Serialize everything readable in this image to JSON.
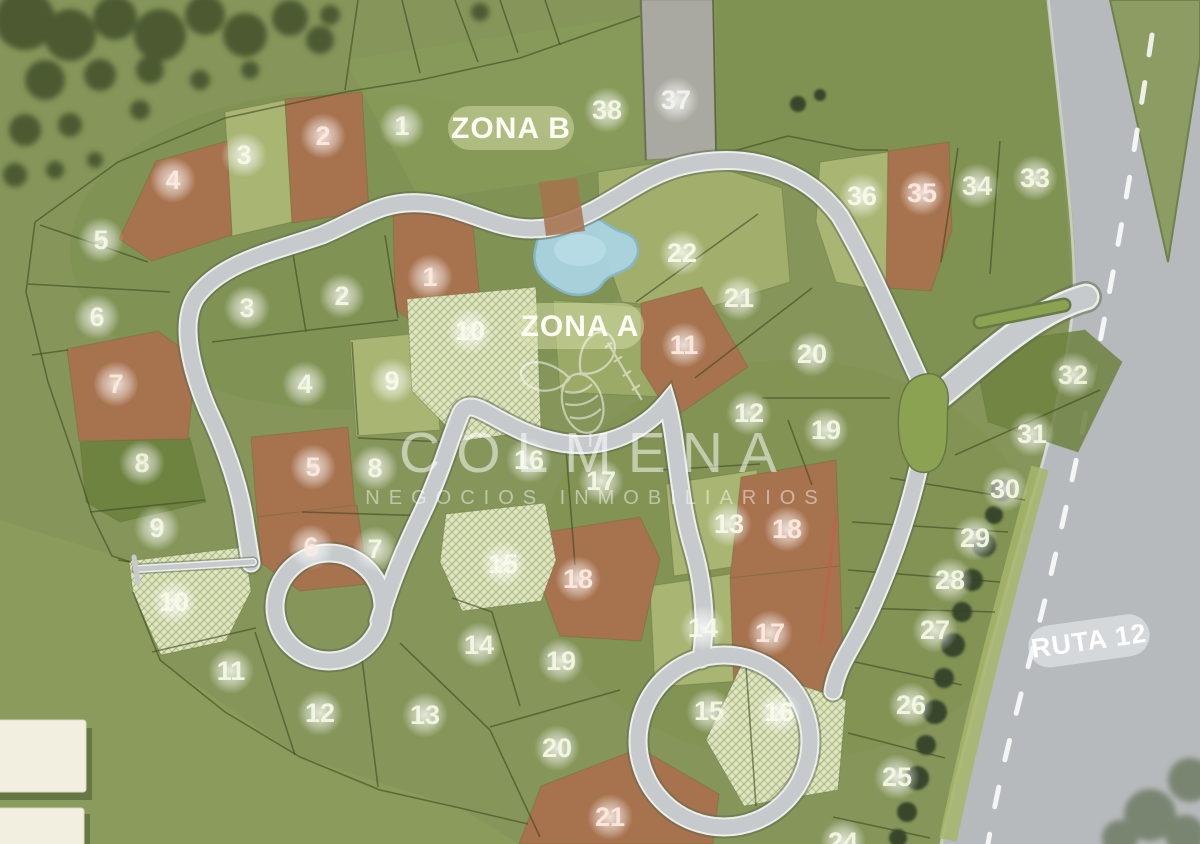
{
  "map": {
    "zone_labels": [
      {
        "text": "ZONA B"
      },
      {
        "text": "ZONA A"
      }
    ],
    "route_label": {
      "text": "RUTA 12"
    },
    "watermark": {
      "brand": "COLMENA",
      "tagline": "NEGOCIOS INMOBILIARIOS"
    },
    "palette": {
      "grass_base": "#86965a",
      "lot_green": "#7d9148",
      "lot_light_olive": "#a9b573",
      "lot_dark_green": "#6f8340",
      "lot_brown": "#a7724e",
      "lot_hatched": "#dfe5c3",
      "lot_gray": "#a9a9a1",
      "road_gray": "#c6cacc",
      "highway_gray": "#b7babc",
      "water_blue": "#aad4e2",
      "tree_green": "#43502c",
      "marker_text": "#ffffff"
    },
    "lots": [
      {
        "ring": "outer",
        "n": 1,
        "x": 402,
        "y": 126,
        "s": "green"
      },
      {
        "ring": "outer",
        "n": 2,
        "x": 323,
        "y": 136,
        "s": "brown"
      },
      {
        "ring": "outer",
        "n": 3,
        "x": 244,
        "y": 155,
        "s": "light"
      },
      {
        "ring": "outer",
        "n": 4,
        "x": 173,
        "y": 180,
        "s": "brown"
      },
      {
        "ring": "outer",
        "n": 5,
        "x": 101,
        "y": 240,
        "s": "green"
      },
      {
        "ring": "outer",
        "n": 6,
        "x": 97,
        "y": 317,
        "s": "green"
      },
      {
        "ring": "outer",
        "n": 7,
        "x": 116,
        "y": 384,
        "s": "brown"
      },
      {
        "ring": "outer",
        "n": 8,
        "x": 142,
        "y": 463,
        "s": "dark"
      },
      {
        "ring": "outer",
        "n": 9,
        "x": 157,
        "y": 528,
        "s": "green"
      },
      {
        "ring": "outer",
        "n": 10,
        "x": 174,
        "y": 602,
        "s": "hatched"
      },
      {
        "ring": "outer",
        "n": 11,
        "x": 231,
        "y": 671,
        "s": "green"
      },
      {
        "ring": "outer",
        "n": 12,
        "x": 320,
        "y": 713,
        "s": "green"
      },
      {
        "ring": "outer",
        "n": 13,
        "x": 425,
        "y": 715,
        "s": "green"
      },
      {
        "ring": "outer",
        "n": 14,
        "x": 479,
        "y": 645,
        "s": "green"
      },
      {
        "ring": "outer",
        "n": 15,
        "x": 503,
        "y": 564,
        "s": "hatched"
      },
      {
        "ring": "outer",
        "n": 16,
        "x": 529,
        "y": 460,
        "s": "green"
      },
      {
        "ring": "outer",
        "n": 17,
        "x": 601,
        "y": 481,
        "s": "green"
      },
      {
        "ring": "outer",
        "n": 18,
        "x": 578,
        "y": 579,
        "s": "brown"
      },
      {
        "ring": "outer",
        "n": 19,
        "x": 561,
        "y": 661,
        "s": "green"
      },
      {
        "ring": "outer",
        "n": 20,
        "x": 557,
        "y": 748,
        "s": "green"
      },
      {
        "ring": "outer",
        "n": 21,
        "x": 610,
        "y": 817,
        "s": "brown"
      },
      {
        "ring": "outer",
        "n": 24,
        "x": 843,
        "y": 842,
        "s": "green"
      },
      {
        "ring": "outer",
        "n": 25,
        "x": 897,
        "y": 777,
        "s": "green"
      },
      {
        "ring": "outer",
        "n": 26,
        "x": 911,
        "y": 705,
        "s": "green"
      },
      {
        "ring": "outer",
        "n": 27,
        "x": 935,
        "y": 630,
        "s": "green"
      },
      {
        "ring": "outer",
        "n": 28,
        "x": 950,
        "y": 580,
        "s": "green"
      },
      {
        "ring": "outer",
        "n": 29,
        "x": 975,
        "y": 538,
        "s": "green"
      },
      {
        "ring": "outer",
        "n": 30,
        "x": 1005,
        "y": 489,
        "s": "green"
      },
      {
        "ring": "outer",
        "n": 31,
        "x": 1032,
        "y": 434,
        "s": "green"
      },
      {
        "ring": "outer",
        "n": 32,
        "x": 1073,
        "y": 375,
        "s": "dark"
      },
      {
        "ring": "outer",
        "n": 33,
        "x": 1035,
        "y": 178,
        "s": "green"
      },
      {
        "ring": "outer",
        "n": 34,
        "x": 977,
        "y": 186,
        "s": "green"
      },
      {
        "ring": "outer",
        "n": 35,
        "x": 922,
        "y": 193,
        "s": "brown"
      },
      {
        "ring": "outer",
        "n": 36,
        "x": 862,
        "y": 196,
        "s": "light"
      },
      {
        "ring": "outer",
        "n": 37,
        "x": 676,
        "y": 100,
        "s": "gray"
      },
      {
        "ring": "outer",
        "n": 38,
        "x": 607,
        "y": 110,
        "s": "green"
      },
      {
        "ring": "inner",
        "n": 1,
        "x": 430,
        "y": 277,
        "s": "brown"
      },
      {
        "ring": "inner",
        "n": 2,
        "x": 342,
        "y": 296,
        "s": "green"
      },
      {
        "ring": "inner",
        "n": 3,
        "x": 247,
        "y": 308,
        "s": "green"
      },
      {
        "ring": "inner",
        "n": 4,
        "x": 305,
        "y": 384,
        "s": "green"
      },
      {
        "ring": "inner",
        "n": 5,
        "x": 313,
        "y": 467,
        "s": "brown"
      },
      {
        "ring": "inner",
        "n": 6,
        "x": 311,
        "y": 547,
        "s": "brown"
      },
      {
        "ring": "inner",
        "n": 7,
        "x": 375,
        "y": 549,
        "s": "green"
      },
      {
        "ring": "inner",
        "n": 8,
        "x": 375,
        "y": 468,
        "s": "green"
      },
      {
        "ring": "inner",
        "n": 9,
        "x": 392,
        "y": 381,
        "s": "light"
      },
      {
        "ring": "inner",
        "n": 10,
        "x": 470,
        "y": 331,
        "s": "hatched"
      },
      {
        "ring": "inner",
        "n": 11,
        "x": 684,
        "y": 345,
        "s": "brown"
      },
      {
        "ring": "inner",
        "n": 12,
        "x": 749,
        "y": 413,
        "s": "green"
      },
      {
        "ring": "inner",
        "n": 13,
        "x": 729,
        "y": 524,
        "s": "light"
      },
      {
        "ring": "inner",
        "n": 14,
        "x": 703,
        "y": 628,
        "s": "light"
      },
      {
        "ring": "inner",
        "n": 15,
        "x": 709,
        "y": 711,
        "s": "green"
      },
      {
        "ring": "inner",
        "n": 16,
        "x": 779,
        "y": 712,
        "s": "hatched"
      },
      {
        "ring": "inner",
        "n": 17,
        "x": 770,
        "y": 633,
        "s": "brown"
      },
      {
        "ring": "inner",
        "n": 18,
        "x": 787,
        "y": 529,
        "s": "brown"
      },
      {
        "ring": "inner",
        "n": 19,
        "x": 826,
        "y": 430,
        "s": "green"
      },
      {
        "ring": "inner",
        "n": 20,
        "x": 812,
        "y": 354,
        "s": "green"
      },
      {
        "ring": "inner",
        "n": 21,
        "x": 739,
        "y": 298,
        "s": "green"
      },
      {
        "ring": "inner",
        "n": 22,
        "x": 682,
        "y": 253,
        "s": "light"
      }
    ]
  }
}
